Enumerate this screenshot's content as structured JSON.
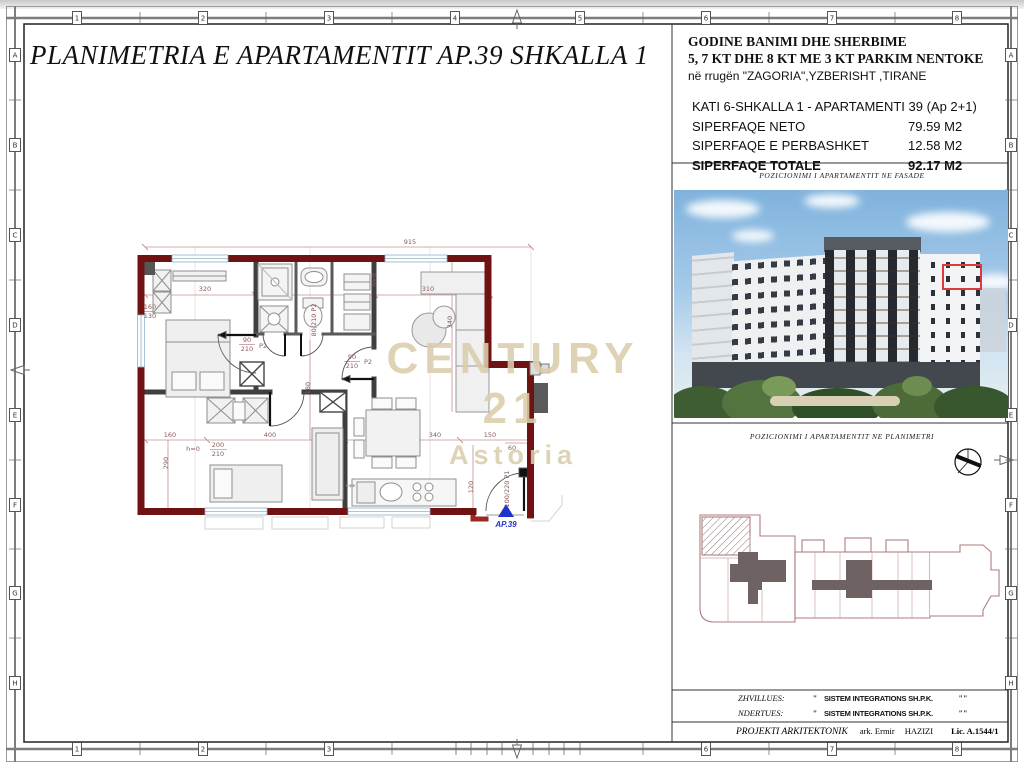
{
  "sheet": {
    "title": "PLANIMETRIA E APARTAMENTIT AP.39 SHKALLA 1"
  },
  "frame": {
    "top_labels": [
      "1",
      "2",
      "3",
      "4",
      "5",
      "6",
      "7",
      "8"
    ],
    "bottom_labels": [
      "1",
      "2",
      "3",
      "6",
      "7",
      "8"
    ],
    "side_labels": [
      "A",
      "B",
      "C",
      "D",
      "E",
      "F",
      "G",
      "H"
    ]
  },
  "info": {
    "building_line1": "GODINE BANIMI DHE SHERBIME",
    "building_line2": "5, 7 KT DHE 8 KT ME 3 KT PARKIM NENTOKE",
    "address": "në rrugën \"ZAGORIA\",YZBERISHT ,TIRANE",
    "unit_line": "KATI 6-SHKALLA 1 - APARTAMENTI 39  (Ap 2+1)",
    "rows": [
      {
        "label": "SIPERFAQE NETO",
        "value": "79.59 M2"
      },
      {
        "label": "SIPERFAQE E PERBASHKET",
        "value": "12.58 M2"
      },
      {
        "label": "SIPERFAQE TOTALE",
        "value": "92.17 M2"
      }
    ]
  },
  "captions": {
    "fasade": "POZICIONIMI I APARTAMENTIT NE FASADE",
    "planimetri": "POZICIONIMI I APARTAMENTIT NE PLANIMETRI"
  },
  "watermark": {
    "line1": "CENTURY 21",
    "line2": "Astoria",
    "color": "#dbcdad"
  },
  "plan": {
    "unit_label": "AP.39",
    "dim_labels": [
      {
        "t": "915",
        "x": 410,
        "y": 244
      },
      {
        "t": "320",
        "x": 205,
        "y": 291
      },
      {
        "t": "310",
        "x": 428,
        "y": 291
      },
      {
        "t": "340",
        "x": 452,
        "y": 322,
        "r": -90
      },
      {
        "t": "180",
        "x": 310,
        "y": 388,
        "r": -90
      },
      {
        "t": "160",
        "x": 170,
        "y": 437
      },
      {
        "t": "400",
        "x": 270,
        "y": 437
      },
      {
        "t": "340",
        "x": 435,
        "y": 437
      },
      {
        "t": "150",
        "x": 490,
        "y": 437
      },
      {
        "t": "60",
        "x": 512,
        "y": 450
      },
      {
        "t": "290",
        "x": 168,
        "y": 463,
        "r": -90
      },
      {
        "t": "120",
        "x": 473,
        "y": 487,
        "r": -90
      },
      {
        "t": "h=0",
        "x": 193,
        "y": 451
      },
      {
        "t": "200",
        "x": 218,
        "y": 447
      },
      {
        "t": "210",
        "x": 218,
        "y": 456
      },
      {
        "t": "90",
        "x": 247,
        "y": 342
      },
      {
        "t": "210",
        "x": 247,
        "y": 351
      },
      {
        "t": "P2",
        "x": 263,
        "y": 348
      },
      {
        "t": "80/210 P2",
        "x": 316,
        "y": 320,
        "r": -90
      },
      {
        "t": "90",
        "x": 352,
        "y": 359
      },
      {
        "t": "210",
        "x": 352,
        "y": 368
      },
      {
        "t": "P2",
        "x": 368,
        "y": 364
      },
      {
        "t": "100/220 P1",
        "x": 509,
        "y": 489,
        "r": -90
      },
      {
        "t": "h=0",
        "x": 376,
        "y": 280,
        "r": -90
      },
      {
        "t": "160",
        "x": 150,
        "y": 309
      },
      {
        "t": "130",
        "x": 150,
        "y": 318
      }
    ]
  },
  "titleblock": {
    "rows": [
      {
        "label": "ZHVILLUES:",
        "open_quote": "\"",
        "value": "SISTEM INTEGRATIONS SH.P.K.",
        "close_quote": "\"\""
      },
      {
        "label": "NDERTUES:",
        "open_quote": "\"",
        "value": "SISTEM INTEGRATIONS SH.P.K.",
        "close_quote": "\"\""
      }
    ],
    "project_label": "PROJEKTI ARKITEKTONIK",
    "architect_prefix": "ark. Ermir",
    "architect_surname": "HAZIZI",
    "license": "Lic. A.1544/1"
  },
  "colors": {
    "wall_red": "#9b2822",
    "dim_red": "#c49090",
    "accent_blue": "#2233cc"
  }
}
